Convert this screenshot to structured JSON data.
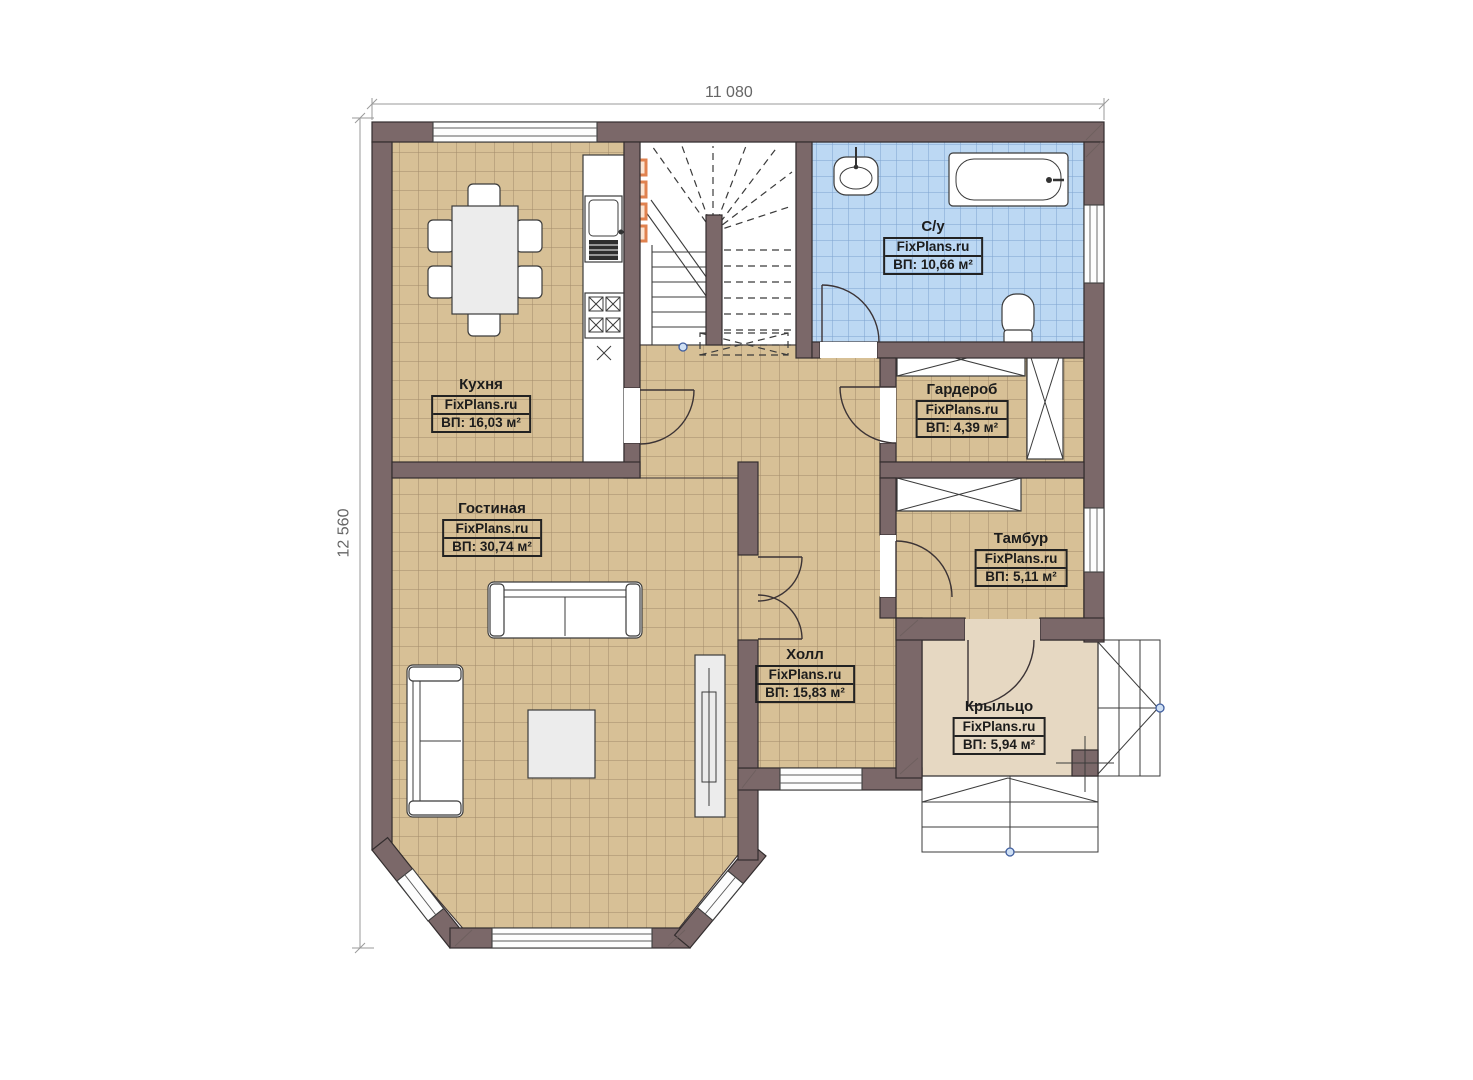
{
  "dimensions": {
    "width": "11 080",
    "depth": "12 560"
  },
  "rooms": [
    {
      "id": "kitchen",
      "name": "Кухня",
      "brand": "FixPlans.ru",
      "area": "ВП: 16,03 м²"
    },
    {
      "id": "bathroom",
      "name": "С/у",
      "brand": "FixPlans.ru",
      "area": "ВП: 10,66 м²"
    },
    {
      "id": "wardrobe",
      "name": "Гардероб",
      "brand": "FixPlans.ru",
      "area": "ВП: 4,39 м²"
    },
    {
      "id": "living",
      "name": "Гостиная",
      "brand": "FixPlans.ru",
      "area": "ВП: 30,74 м²"
    },
    {
      "id": "tambour",
      "name": "Тамбур",
      "brand": "FixPlans.ru",
      "area": "ВП: 5,11 м²"
    },
    {
      "id": "hall",
      "name": "Холл",
      "brand": "FixPlans.ru",
      "area": "ВП: 15,83 м²"
    },
    {
      "id": "porch",
      "name": "Крыльцо",
      "brand": "FixPlans.ru",
      "area": "ВП: 5,94 м²"
    }
  ],
  "colors": {
    "wall": "#7b6869",
    "floor_tile": "#d7c096",
    "bath_tile": "#bcd8f3",
    "porch_floor": "#e6d8c2",
    "vent_orange": "#e0824f"
  }
}
